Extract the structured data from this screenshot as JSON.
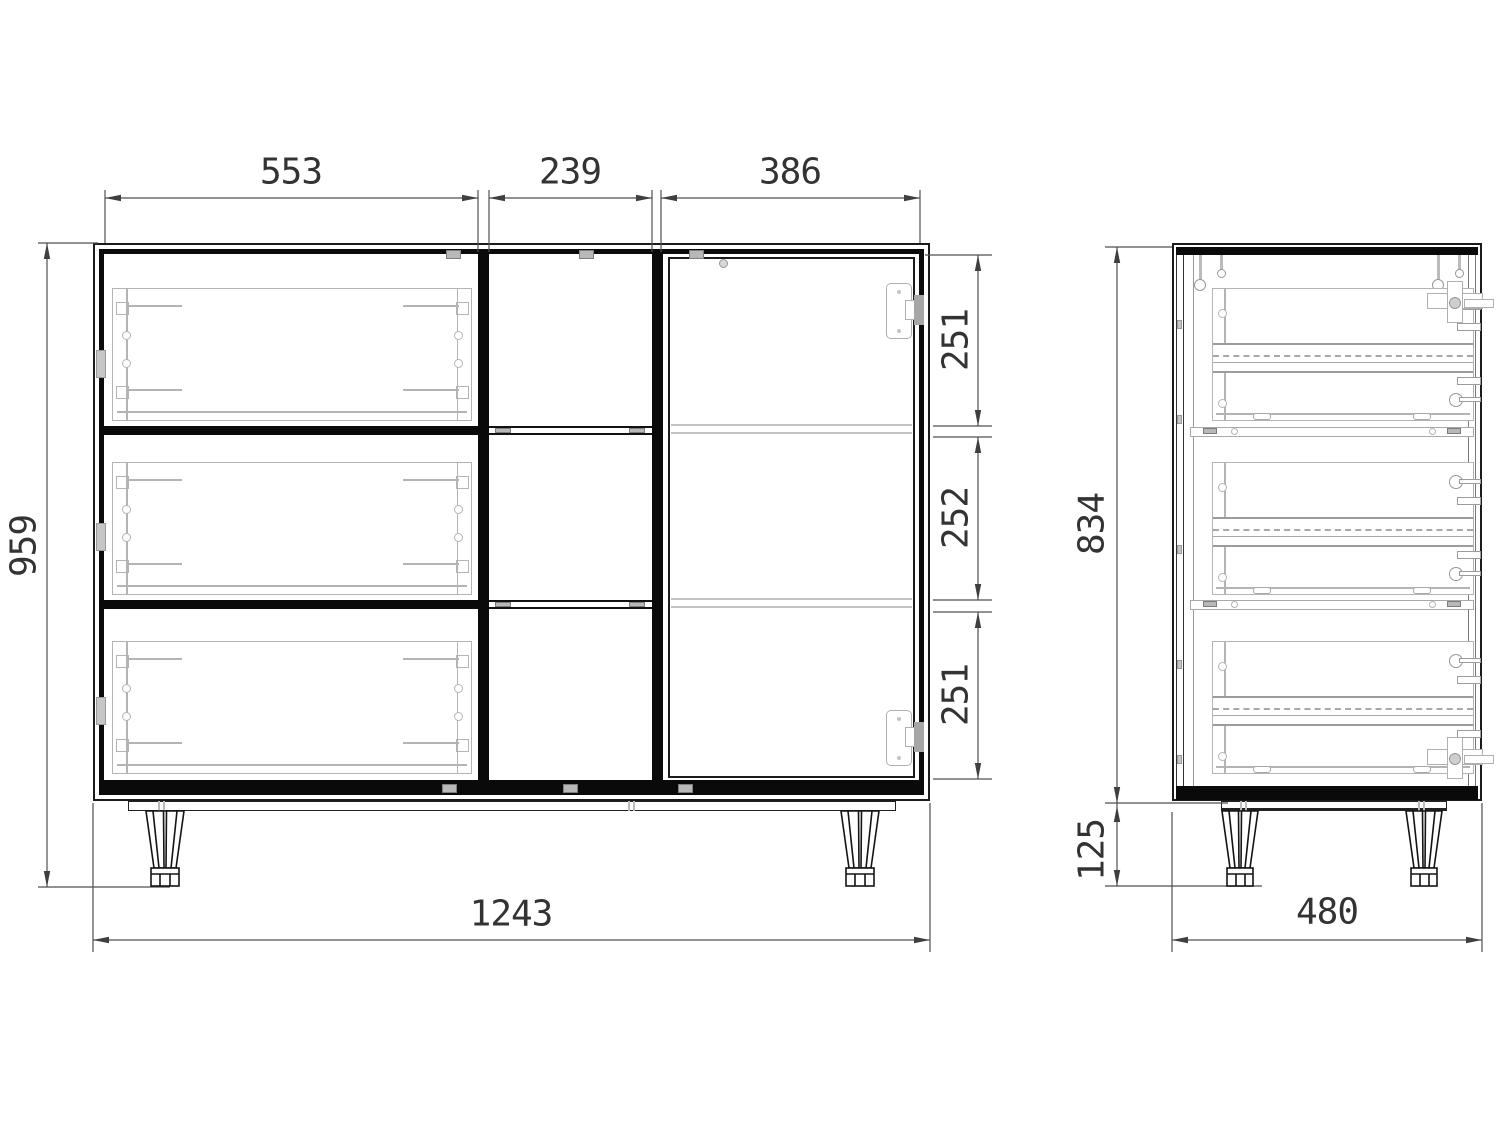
{
  "dims": {
    "front_top_left_width": "553",
    "front_top_middle_width": "239",
    "front_top_right_width": "386",
    "front_overall_height": "959",
    "front_compartment_top_height": "251",
    "front_compartment_middle_height": "252",
    "front_compartment_bottom_height": "251",
    "front_overall_width": "1243",
    "side_carcass_height": "834",
    "side_leg_height": "125",
    "side_overall_depth": "480"
  }
}
